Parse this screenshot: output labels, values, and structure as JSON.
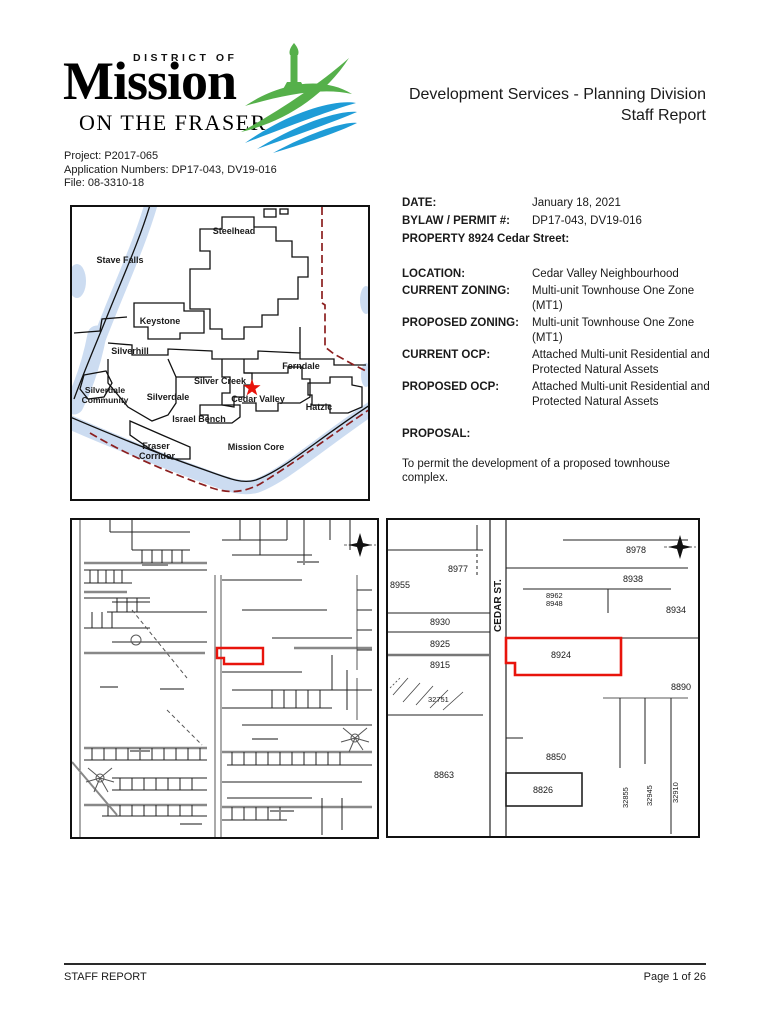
{
  "header": {
    "logo": {
      "district_of": "DISTRICT OF",
      "mission": "Mission",
      "on_the_fraser": "ON THE FRASER",
      "green": "#55b04a",
      "blue": "#1e9cd7"
    },
    "title_line1": "Development Services - Planning Division",
    "title_line2": "Staff Report"
  },
  "project_info": {
    "project": "Project: P2017-065",
    "applications": "Application Numbers:  DP17-043, DV19-016",
    "file": "File: 08-3310-18"
  },
  "details": {
    "date_label": "DATE:",
    "date_value": "January 18, 2021",
    "permit_label": "BYLAW / PERMIT #:",
    "permit_value": "DP17-043, DV19-016",
    "property_heading": "PROPERTY 8924 Cedar Street:",
    "location_label": "LOCATION:",
    "location_value": "Cedar Valley Neighbourhood",
    "current_zoning_label": "CURRENT ZONING:",
    "current_zoning_value": "Multi-unit Townhouse One Zone (MT1)",
    "proposed_zoning_label": "PROPOSED ZONING:",
    "proposed_zoning_value": "Multi-unit Townhouse One Zone (MT1)",
    "current_ocp_label": "CURRENT OCP:",
    "current_ocp_value": "Attached Multi-unit Residential and Protected Natural Assets",
    "proposed_ocp_label": "PROPOSED OCP:",
    "proposed_ocp_value": "Attached Multi-unit Residential and Protected Natural Assets",
    "proposal_heading": "PROPOSAL:",
    "proposal_text": "To permit the development of a proposed townhouse complex."
  },
  "region_map": {
    "water_color": "#ccdcf1",
    "boundary_color": "#8c1f1f",
    "star_color": "#e8140c",
    "labels": {
      "steelhead": "Steelhead",
      "stave_falls": "Stave Falls",
      "keystone": "Keystone",
      "silverhill": "Silverhill",
      "ferndale": "Ferndale",
      "silver_creek": "Silver Creek",
      "silverdale": "Silverdale",
      "cedar_valley": "Cedar Valley",
      "silverdale_community_1": "Silverdale",
      "silverdale_community_2": "Community",
      "israel_bench": "Israel Bench",
      "hatzic": "Hatzic",
      "fraser_corridor_1": "Fraser",
      "fraser_corridor_2": "Corridor",
      "mission_core": "Mission Core"
    }
  },
  "site_map": {
    "highlight_color": "#e8140c"
  },
  "parcel_map": {
    "street_label": "CEDAR ST.",
    "highlighted_lot": "8924",
    "highlight_color": "#e8140c",
    "lots": {
      "l8955": "8955",
      "l8977": "8977",
      "l8930": "8930",
      "l8925": "8925",
      "l8915": "8915",
      "l32751": "32751",
      "l8863": "8863",
      "l8978": "8978",
      "l8938": "8938",
      "l8962": "8962",
      "l8948": "8948",
      "l8934": "8934",
      "l8924": "8924",
      "l8890": "8890",
      "l8850": "8850",
      "l8826": "8826",
      "l32855": "32855",
      "l32945": "32945",
      "l32910": "32910"
    }
  },
  "footer": {
    "left": "STAFF REPORT",
    "right": "Page 1 of 26"
  }
}
